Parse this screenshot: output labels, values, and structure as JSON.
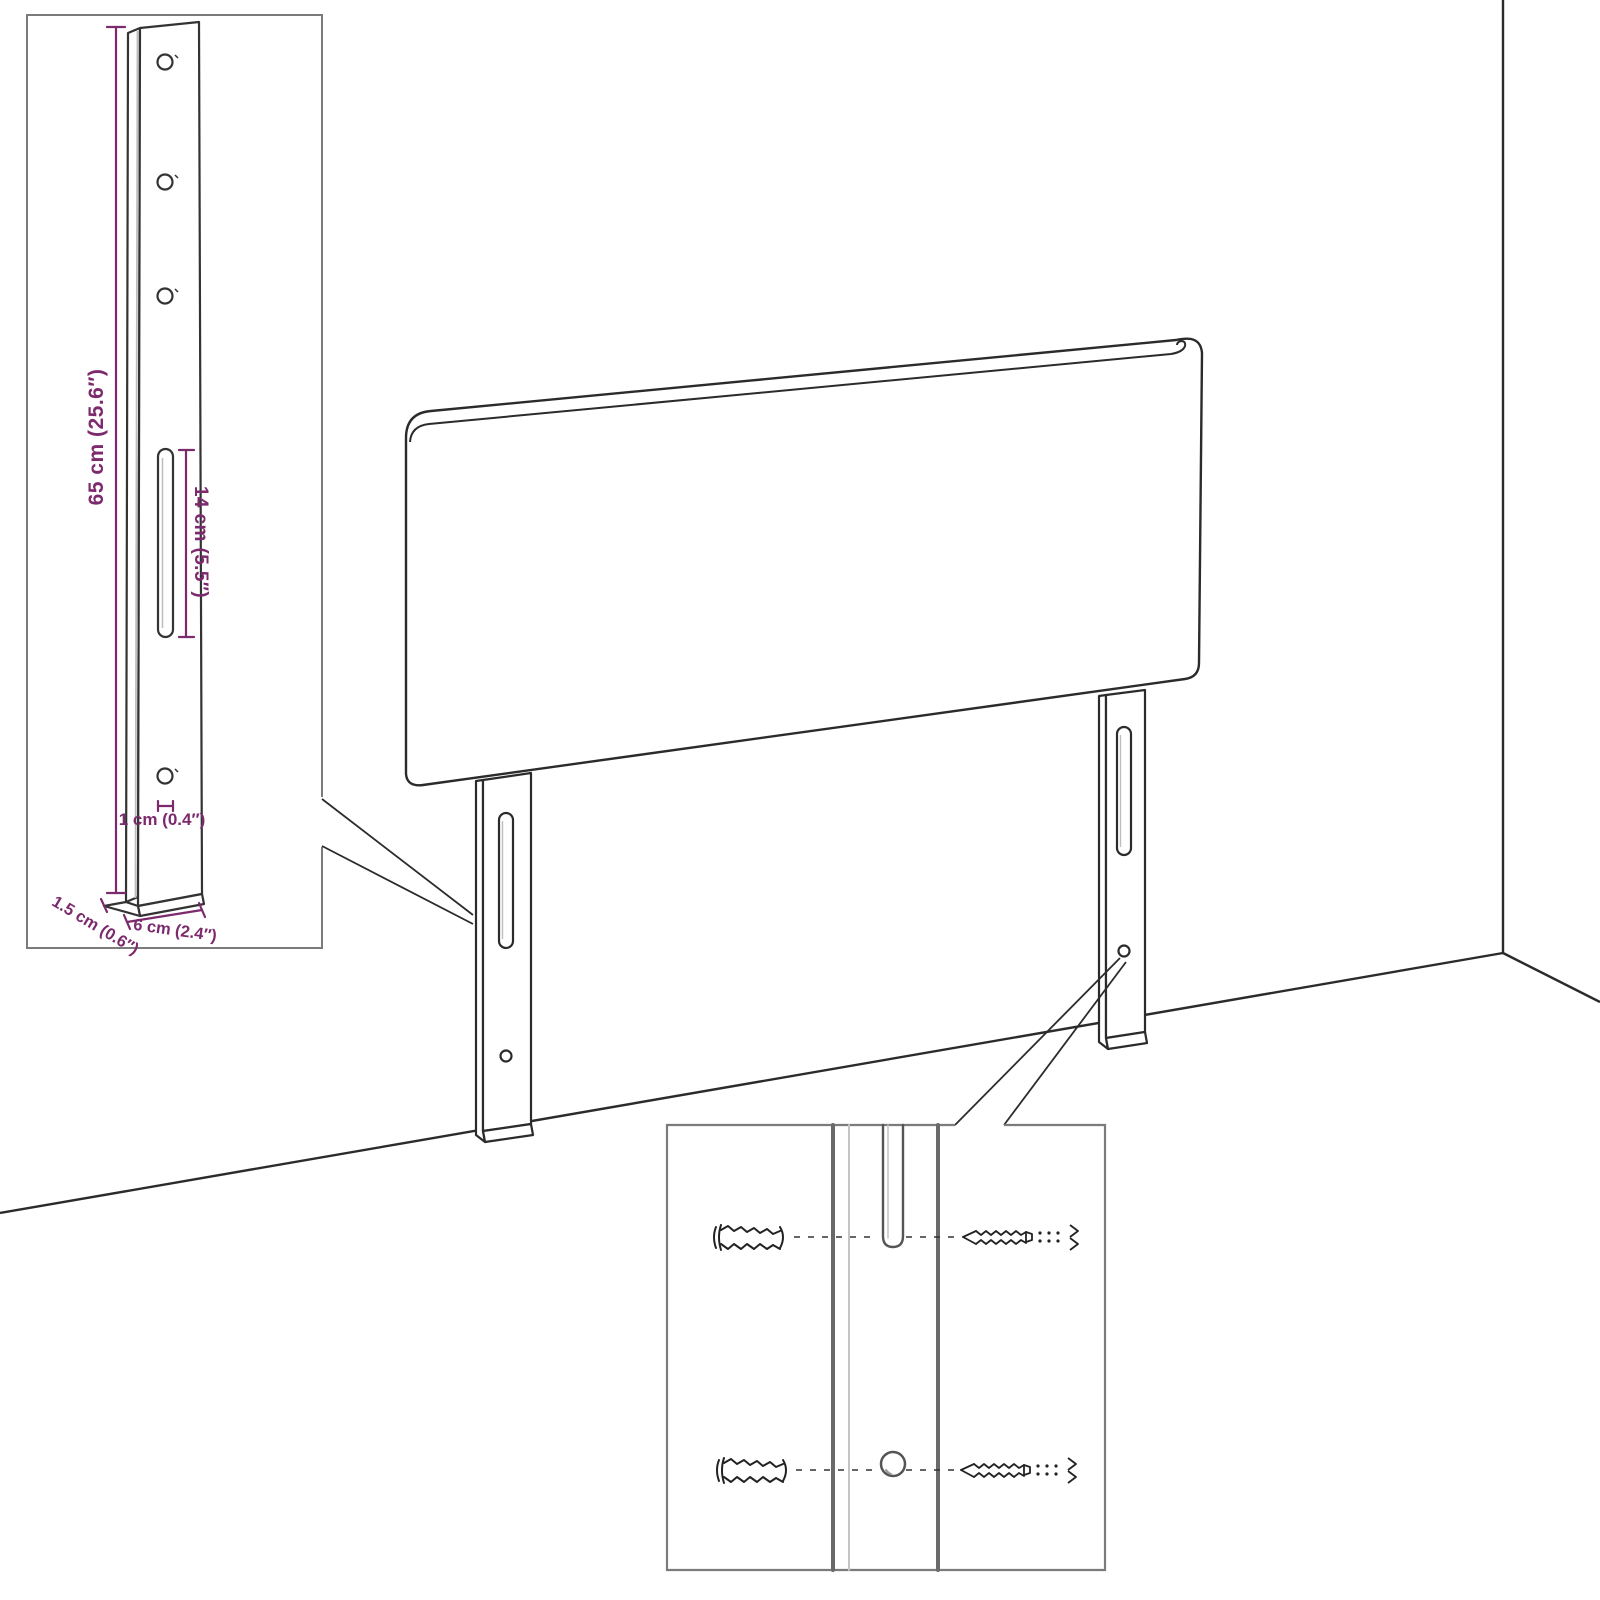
{
  "diagram": {
    "inset_leg_detail": {
      "labels": {
        "leg_height": "65 cm (25.6″)",
        "slot_length": "14 cm (5.5″)",
        "hole_diameter": "1 cm (0.4″)",
        "leg_depth": "1.5 cm (0.6″)",
        "leg_width": "6 cm (2.4″)"
      }
    },
    "colors": {
      "dimension_text": "#7c2a6d",
      "line_art": "#2b2b2b",
      "inset_border": "#7b7b7b",
      "hardware": "#222222",
      "background": "#ffffff"
    }
  }
}
